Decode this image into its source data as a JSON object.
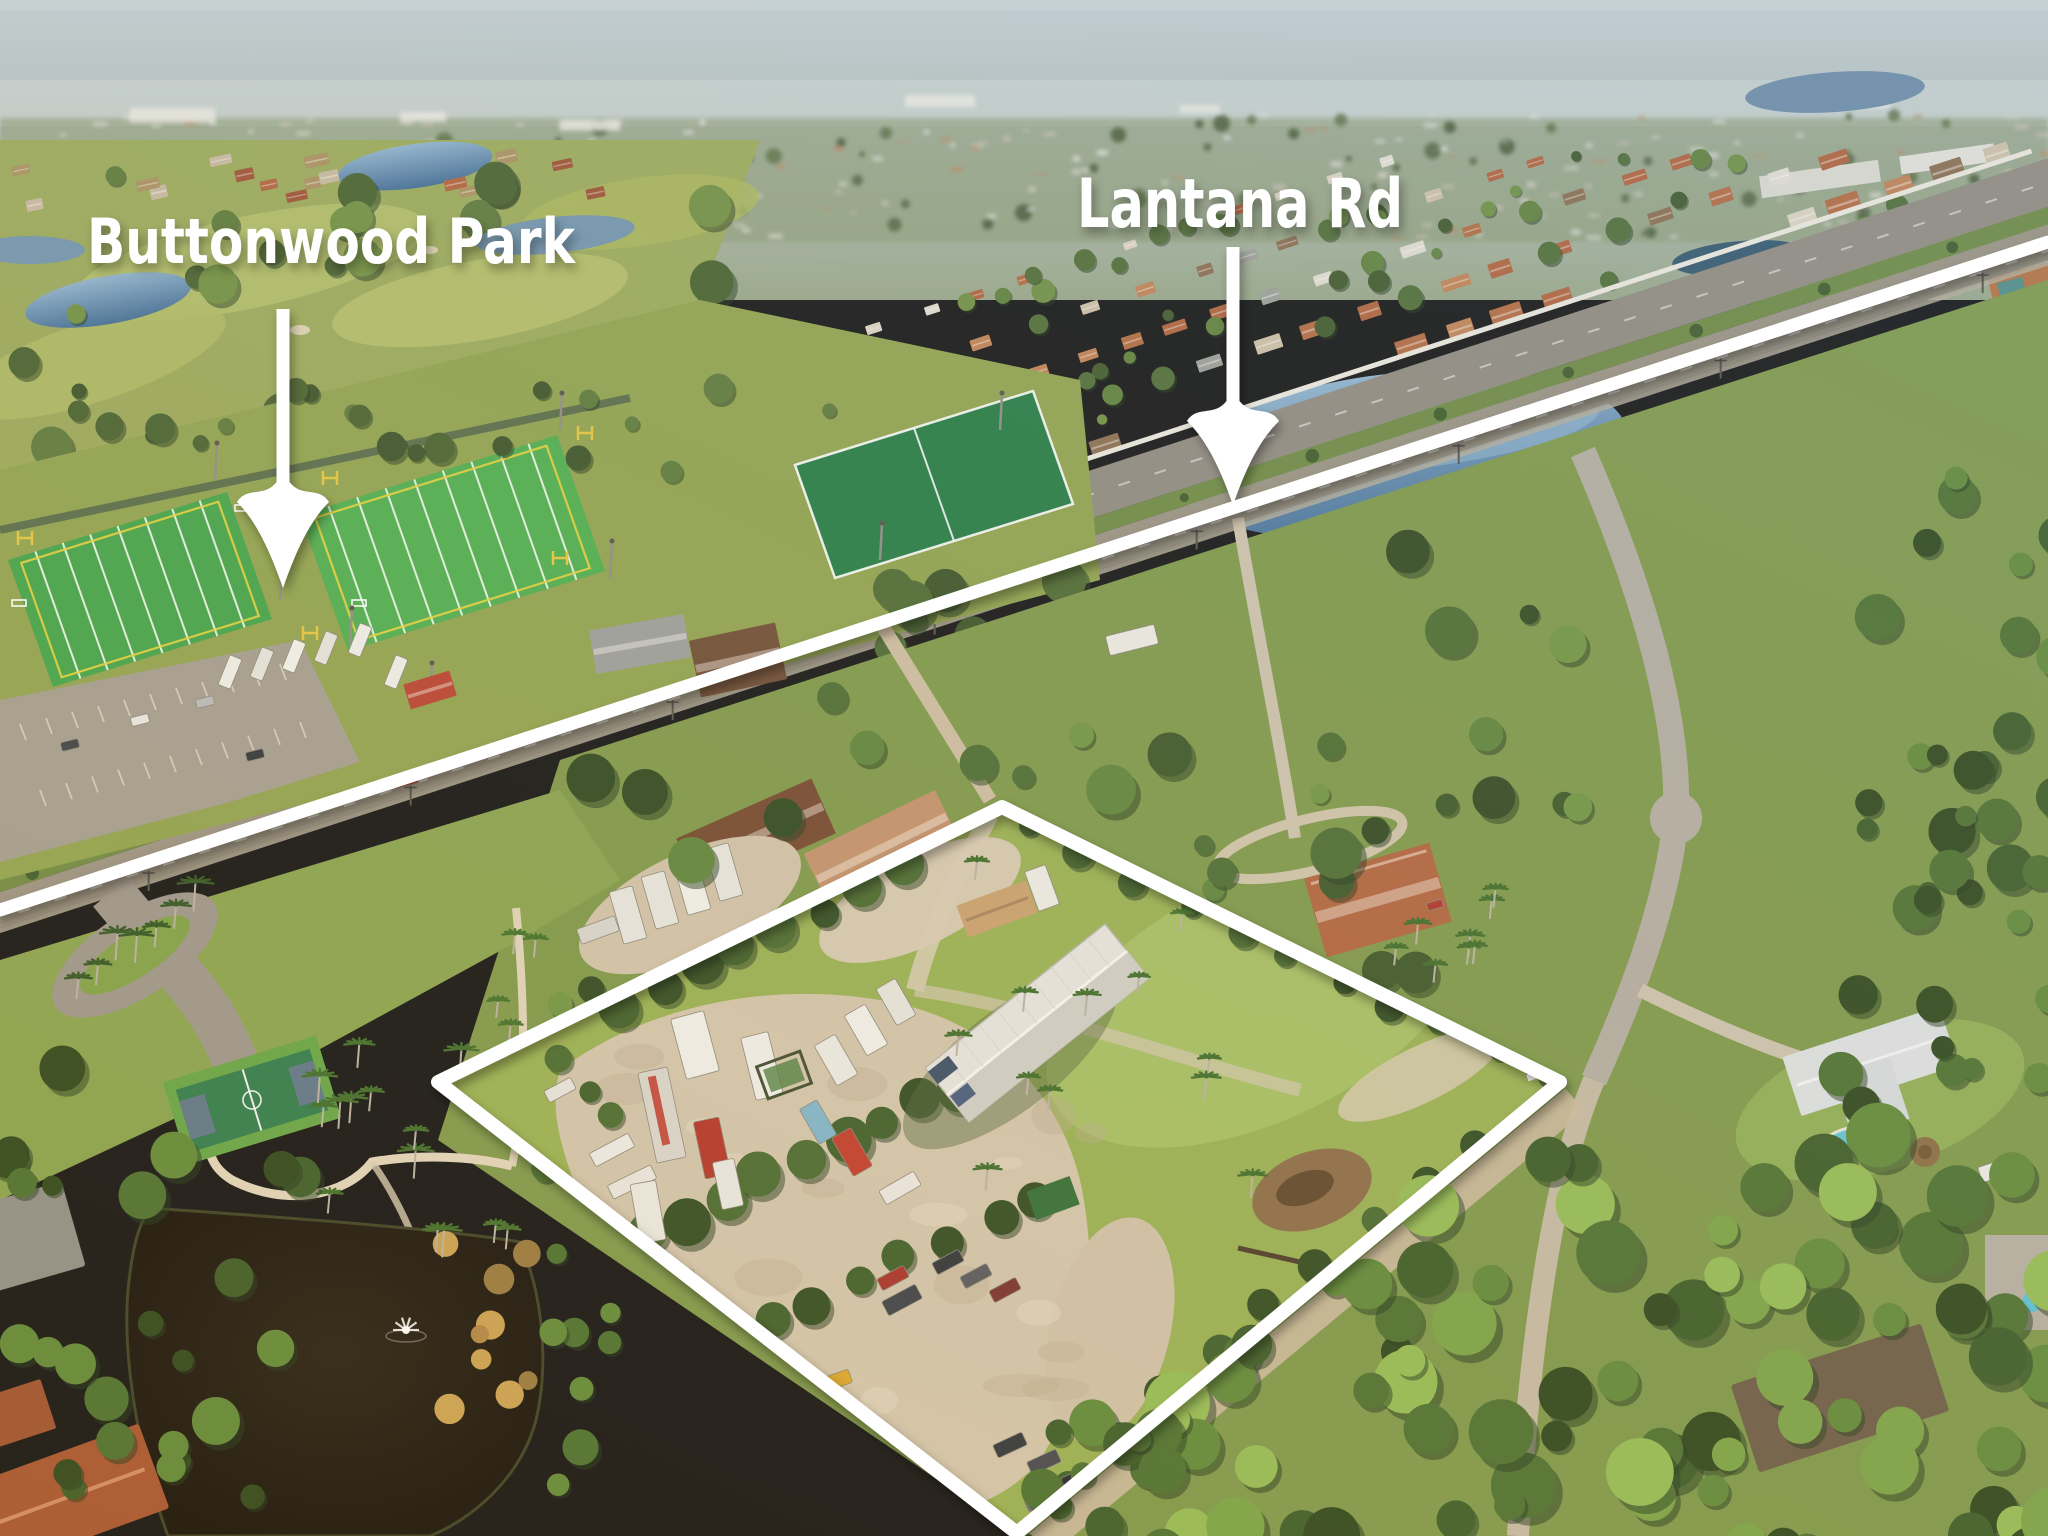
{
  "annotations": {
    "park": {
      "label": "Buttonwood Park",
      "text_color": "#ffffff",
      "x": 87,
      "baseline_y": 263,
      "font_size": 62,
      "text_length": 488,
      "arrow": {
        "cx": 283,
        "top_y": 309,
        "tip_y": 588,
        "shaft_w": 13,
        "head_w": 92,
        "head_h": 92
      }
    },
    "road": {
      "label": "Lantana Rd",
      "text_color": "#ffffff",
      "x": 1077,
      "baseline_y": 227,
      "font_size": 68,
      "text_length": 326,
      "arrow": {
        "cx": 1233,
        "top_y": 247,
        "tip_y": 505,
        "shaft_w": 13,
        "head_w": 92,
        "head_h": 90
      }
    },
    "road_line": {
      "x1": 0,
      "y1": 910,
      "x2": 2048,
      "y2": 242,
      "width": 13,
      "color": "#ffffff"
    },
    "property_outline": {
      "points": "438,1082 1002,807 1560,1082 1017,1533",
      "width": 14,
      "color": "#ffffff"
    }
  },
  "palette": {
    "annotation_white": "#ffffff",
    "sky_haze": "#b8c4c8",
    "distant_green": "#8a9a72",
    "turf_green": "#42a347",
    "dark_field_green": "#237a41",
    "water_blue": "#45719f",
    "pond_dark": "#18130a",
    "sand": "#d2c4aa",
    "grass": "#7d9747",
    "road_grey": "#948d80",
    "roof_terracotta": "#b0613a"
  }
}
